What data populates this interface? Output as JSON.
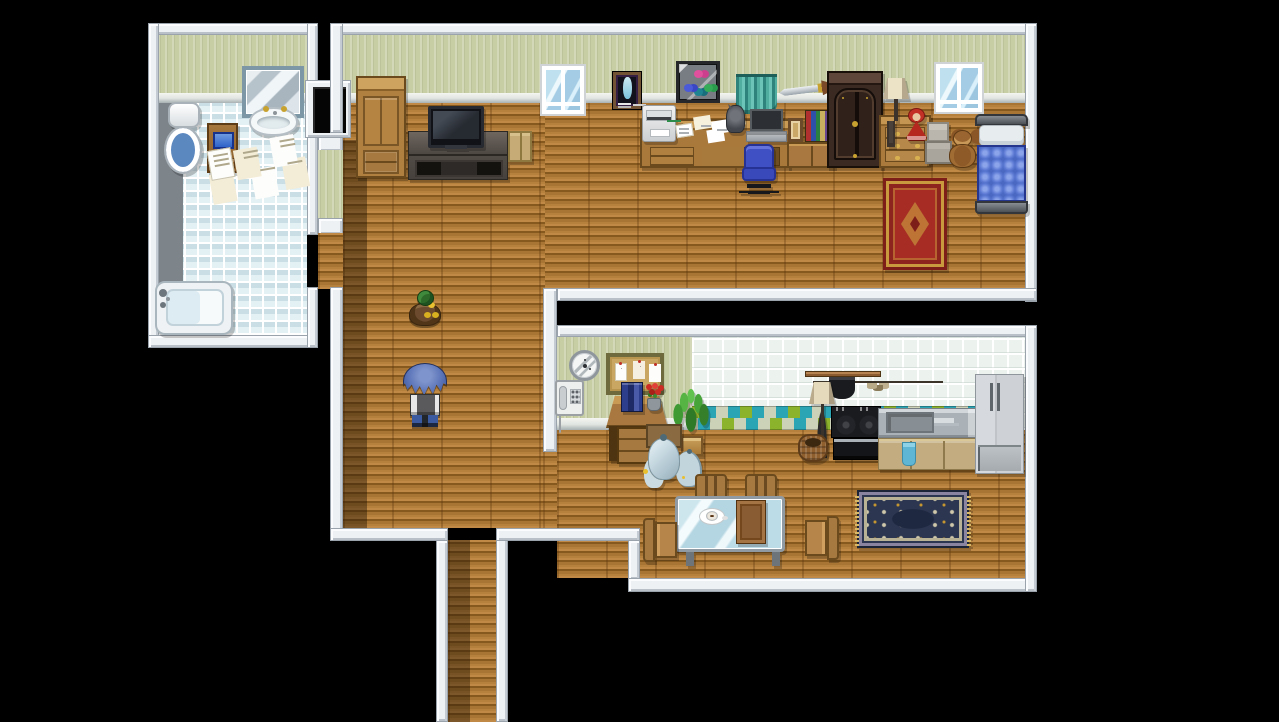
{
  "scene": {
    "title": "RPG Maker style apartment interior map",
    "width": 1279,
    "height": 722,
    "background_color": "#000000",
    "rooms": [
      "bathroom",
      "main-room-with-hallway",
      "kitchen-dining-room"
    ],
    "characters": [
      {
        "id": "player",
        "label": "player character, blue spiky hair, facing away",
        "x": 403,
        "y": 363
      },
      {
        "id": "duck",
        "label": "mallard duck pet",
        "x": 407,
        "y": 290
      }
    ]
  },
  "palette": {
    "void": "#000000",
    "wall_white": "#eef1f3",
    "wall_green": "#c7cea4",
    "wood_floor": "#b5813d",
    "bath_tile": "#e3f0f4",
    "gray_tile": "#7d858b",
    "kitchen_tile": "#ecf3ef",
    "accent_tile_green": "#8cb32c",
    "accent_tile_teal": "#2ba4b4",
    "bed_blue": "#4a67c2",
    "chair_blue": "#3f4fc4",
    "curtain_teal": "#4fae9f",
    "rug_red": "#a62c24",
    "rug_navy": "#2c3650",
    "furniture_wood": "#a87840"
  },
  "sprites": {
    "bath_wall": [
      158,
      33,
      149,
      60
    ],
    "bath_cornice": [
      158,
      93,
      149,
      10
    ],
    "bath_tile": [
      158,
      103,
      149,
      232
    ],
    "bath_gray_tiles": [
      158,
      103,
      25,
      180
    ],
    "conn_wall_white_a": [
      318,
      133,
      25,
      19
    ],
    "conn_wall_green": [
      318,
      150,
      25,
      70
    ],
    "conn_wall_white_b": [
      318,
      218,
      25,
      17
    ],
    "conn_floor": [
      318,
      233,
      25,
      56
    ],
    "main_wall": [
      343,
      35,
      682,
      58
    ],
    "main_cornice": [
      343,
      93,
      682,
      10
    ],
    "floor_main": [
      343,
      103,
      682,
      186
    ],
    "floor_hall": [
      343,
      103,
      202,
      425
    ],
    "shadow_hall": [
      343,
      140,
      24,
      388
    ],
    "floor_corridor": [
      448,
      540,
      48,
      182
    ],
    "shadow_corridor": [
      448,
      540,
      22,
      182
    ],
    "kitchen_wall": [
      557,
      337,
      135,
      81
    ],
    "kitchen_cornice": [
      557,
      418,
      135,
      12
    ],
    "kitchen_tile": [
      692,
      337,
      333,
      93
    ],
    "kitchen_accent": [
      692,
      406,
      283,
      24
    ],
    "floor_kitchen": [
      557,
      430,
      468,
      148
    ],
    "floor_gap": [
      543,
      450,
      14,
      78
    ],
    "rug_red": [
      883,
      178,
      64,
      92
    ],
    "rug_navy": [
      857,
      490,
      112,
      58
    ],
    "w_bath_top": [
      148,
      23,
      170,
      12
    ],
    "w_bath_left": [
      148,
      23,
      11,
      325
    ],
    "w_bath_bottom": [
      148,
      335,
      170,
      13
    ],
    "w_bath_right_up": [
      307,
      23,
      11,
      212
    ],
    "w_bath_right_low": [
      307,
      287,
      11,
      61
    ],
    "door_frame": [
      305,
      80,
      46,
      58
    ],
    "door_hole": [
      313,
      87,
      33,
      46
    ],
    "w_main_top": [
      330,
      23,
      707,
      12
    ],
    "w_main_left_up": [
      330,
      23,
      13,
      110
    ],
    "w_main_left_low": [
      330,
      287,
      13,
      253
    ],
    "w_main_right": [
      1025,
      23,
      12,
      279
    ],
    "w_main_bottom": [
      557,
      288,
      480,
      13
    ],
    "w_hall_bottom": [
      330,
      528,
      118,
      13
    ],
    "w_corr_left": [
      436,
      540,
      12,
      182
    ],
    "w_corr_right": [
      496,
      528,
      12,
      194
    ],
    "w_pass_bottom": [
      496,
      528,
      144,
      13
    ],
    "w_dine_stub": [
      628,
      540,
      12,
      40
    ],
    "w_dine_bottom": [
      628,
      578,
      409,
      14
    ],
    "w_kitchen_top": [
      557,
      325,
      480,
      12
    ],
    "w_kitchen_left": [
      543,
      288,
      14,
      164
    ],
    "w_kitchen_right": [
      1025,
      325,
      12,
      267
    ],
    "mirror": [
      242,
      66,
      62,
      52
    ],
    "sink": [
      249,
      107,
      49,
      29
    ],
    "toilet": [
      164,
      102,
      40,
      77
    ],
    "bath_stand": [
      207,
      123,
      31,
      50
    ],
    "bath_papers": [
      203,
      145,
      140,
      60
    ],
    "bathtub": [
      155,
      281,
      78,
      54
    ],
    "wardrobe_light": [
      356,
      76,
      50,
      102
    ],
    "tv_stand": [
      408,
      131,
      100,
      49
    ],
    "tv": [
      428,
      106,
      56,
      42
    ],
    "side_box": [
      508,
      131,
      24,
      31
    ],
    "window_1": [
      540,
      64,
      46,
      52
    ],
    "window_2": [
      934,
      62,
      50,
      52
    ],
    "poster": [
      612,
      71,
      30,
      39
    ],
    "butterfly_box": [
      676,
      61,
      44,
      42
    ],
    "curtain": [
      736,
      74,
      41,
      40
    ],
    "sword": [
      779,
      78,
      58,
      24
    ],
    "desk_long": [
      640,
      119,
      150,
      49
    ],
    "printer": [
      642,
      105,
      34,
      37
    ],
    "desk_papers": [
      676,
      118,
      70,
      30
    ],
    "figurine": [
      726,
      105,
      19,
      28
    ],
    "laptop": [
      746,
      109,
      41,
      34
    ],
    "office_chair": [
      741,
      144,
      36,
      53
    ],
    "books_cabinet": [
      787,
      118,
      48,
      50
    ],
    "dark_wardrobe": [
      827,
      71,
      56,
      97
    ],
    "dresser": [
      879,
      115,
      52,
      53
    ],
    "table_lamp": [
      883,
      76,
      26,
      54
    ],
    "doll": [
      905,
      108,
      23,
      36
    ],
    "gray_boxes": [
      925,
      122,
      27,
      42
    ],
    "teddy_bear": [
      947,
      130,
      31,
      40
    ],
    "bed": [
      975,
      114,
      53,
      103
    ],
    "clock": [
      569,
      350,
      31,
      31
    ],
    "corkboard": [
      606,
      353,
      58,
      42
    ],
    "phone": [
      555,
      380,
      29,
      36
    ],
    "desk_bureau": [
      606,
      396,
      62,
      70
    ],
    "desk_books": [
      621,
      382,
      22,
      30
    ],
    "flower_pot": [
      643,
      384,
      22,
      28
    ],
    "plant": [
      668,
      380,
      46,
      78
    ],
    "trash_bags": [
      636,
      422,
      60,
      66
    ],
    "hang_rack": [
      805,
      368,
      76,
      36
    ],
    "floor_lamp": [
      808,
      380,
      28,
      78
    ],
    "basket": [
      798,
      434,
      30,
      28
    ],
    "stove": [
      831,
      406,
      50,
      56
    ],
    "counter": [
      878,
      408,
      99,
      62
    ],
    "fridge": [
      975,
      374,
      49,
      100
    ],
    "chair_n1": [
      693,
      474,
      36,
      54
    ],
    "chair_n2": [
      743,
      474,
      36,
      54
    ],
    "glass_table": [
      675,
      496,
      110,
      70
    ],
    "coffee_cup": [
      699,
      504,
      28,
      22
    ],
    "table_book": [
      736,
      500,
      30,
      44
    ],
    "chair_w": [
      643,
      514,
      36,
      56
    ],
    "chair_e": [
      803,
      512,
      36,
      56
    ],
    "duck": [
      407,
      290,
      36,
      38
    ],
    "player": [
      403,
      363,
      44,
      64
    ]
  }
}
